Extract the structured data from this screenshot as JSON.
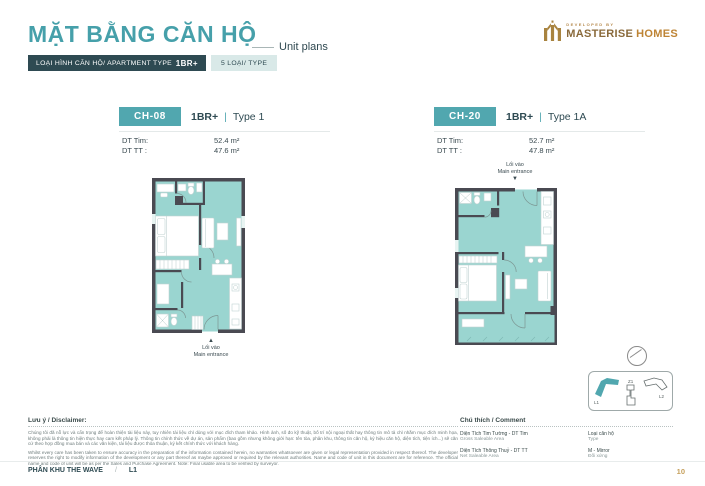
{
  "page": {
    "title_vi": "MẶT BẰNG CĂN HỘ",
    "title_en": "Unit plans",
    "page_number": "10"
  },
  "logo": {
    "developed_by": "DEVELOPED BY",
    "brand_primary": "MASTERISE",
    "brand_secondary": "HOMES"
  },
  "type_bar": {
    "label": "LOẠI HÌNH CĂN HỘ/ APARTMENT TYPE",
    "type": "1BR+",
    "count": "5 LOẠI/ TYPE"
  },
  "ui": {
    "pipe": "|"
  },
  "units": [
    {
      "code": "CH-08",
      "type": "1BR+",
      "variant": "Type 1",
      "dt_tim_label": "DT Tim:",
      "dt_tim_value": "52.4 m²",
      "dt_tt_label": "DT TT :",
      "dt_tt_value": "47.6 m²",
      "entrance_vi": "Lối vào",
      "entrance_en": "Main entrance",
      "entrance_arrow": "▲"
    },
    {
      "code": "CH-20",
      "type": "1BR+",
      "variant": "Type 1A",
      "dt_tim_label": "DT Tim:",
      "dt_tim_value": "52.7 m²",
      "dt_tt_label": "DT TT :",
      "dt_tt_value": "47.8 m²",
      "entrance_vi": "Lối vào",
      "entrance_en": "Main entrance",
      "entrance_arrow": "▼"
    }
  ],
  "legend": {
    "title": "Chú thích / Comment",
    "rows": [
      {
        "vi": "Diện Tích Tim Tường - DT Tim",
        "en": "Gross Saleable Area"
      },
      {
        "vi": "Loại căn hộ",
        "en": "Type"
      },
      {
        "vi": "Diện Tích Thông Thuỷ - DT TT",
        "en": "Net Saleable Area"
      },
      {
        "vi": "M - Mirror",
        "en": "Đối xứng"
      }
    ]
  },
  "keyplan": {
    "l1": "L1",
    "z1": "Z1",
    "l2": "L2"
  },
  "disclaimer": {
    "title": "Lưu ý / Disclaimer:",
    "vi": "Chúng tôi đã nỗ lực và cẩn trọng để hoàn thiện tài liệu này, tuy nhiên tài liệu chỉ dùng với mục đích tham khảo. Hình ảnh, số đo kỹ thuật, bố trí nội ngoại thất hay thông tin mô tả chỉ nhằm mục đích minh họa, không phải là thông tin hiện thực hay cam kết pháp lý. Thông tin chính thức về dự án, sản phẩm (bao gồm nhưng không giới hạn: tên tòa, phân khu, thông tin căn hộ, ký hiệu căn hộ, diện tích, tiện ích...) sẽ căn cứ theo hợp đồng mua bán và các văn kiện, tài liệu được thỏa thuận, ký kết chính thức với khách hàng.",
    "en": "Whilst every care has been taken to ensure accuracy in the preparation of the information contained herein, no warranties whatsoever are given or legal representation provided in respect thereof. The developer reserves the right to modify information of the development or any part thereof as maybe approved or required by the relevant authorities. Name and code of unit in this document are for reference. The official name and code of unit will be as per the Sales and Purchase Agreement. Note: Final usable area to be verified by surveyor."
  },
  "footer": {
    "zone": "PHÂN KHU THE WAVE",
    "separator": "/",
    "block": "L1"
  }
}
